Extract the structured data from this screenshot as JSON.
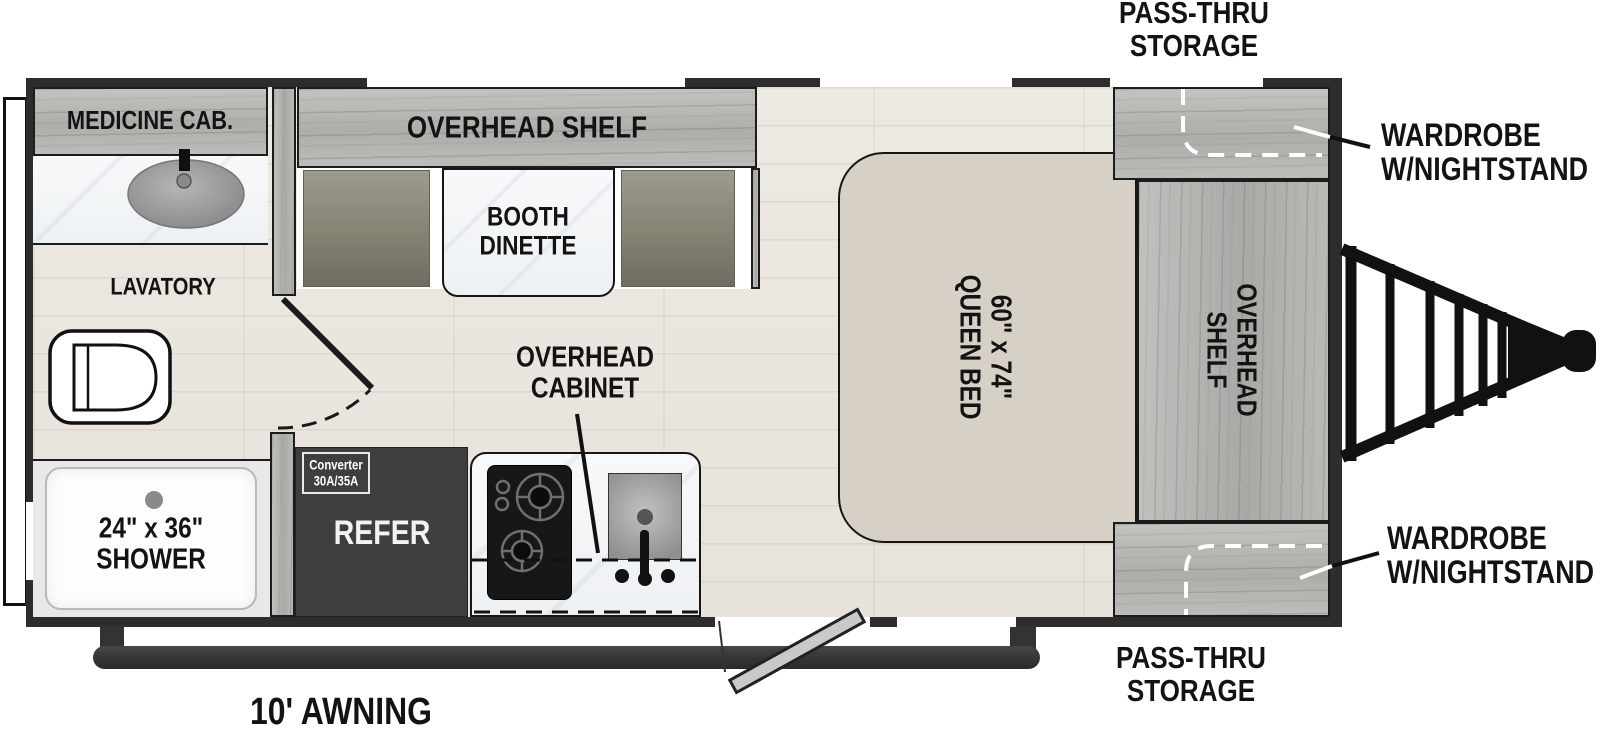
{
  "plan": {
    "bathroom": {
      "medicine_cab_label": "MEDICINE CAB.",
      "lavatory_label": "LAVATORY",
      "shower_size": "24\" x 36\"",
      "shower_label": "SHOWER"
    },
    "dinette": {
      "shelf_label": "OVERHEAD SHELF",
      "booth_line1": "BOOTH",
      "booth_line2": "DINETTE"
    },
    "kitchen": {
      "cabinet_line1": "OVERHEAD",
      "cabinet_line2": "CABINET",
      "refer_label": "REFER",
      "converter_line1": "Converter",
      "converter_line2": "30A/35A"
    },
    "bedroom": {
      "bed_size": "60\" x 74\"",
      "bed_label": "QUEEN BED",
      "shelf_line1": "OVERHEAD",
      "shelf_line2": "SHELF",
      "wardrobe_top_line1": "WARDROBE",
      "wardrobe_top_line2": "W/NIGHTSTAND",
      "wardrobe_bottom_line1": "WARDROBE",
      "wardrobe_bottom_line2": "W/NIGHTSTAND"
    },
    "exterior": {
      "pass_thru_top_line1": "PASS-THRU",
      "pass_thru_top_line2": "STORAGE",
      "pass_thru_bottom_line1": "PASS-THRU",
      "pass_thru_bottom_line2": "STORAGE",
      "awning_label": "10' AWNING"
    }
  },
  "colors": {
    "wall": "#2d2d2d",
    "floor": "#eae6e0",
    "cabinet_wood": "#b5b5b2",
    "bench": "#87857a",
    "marble": "#f5f7f8",
    "bed": "#d6d0c7",
    "refer": "#3e3e3e",
    "frame": "#161616"
  }
}
